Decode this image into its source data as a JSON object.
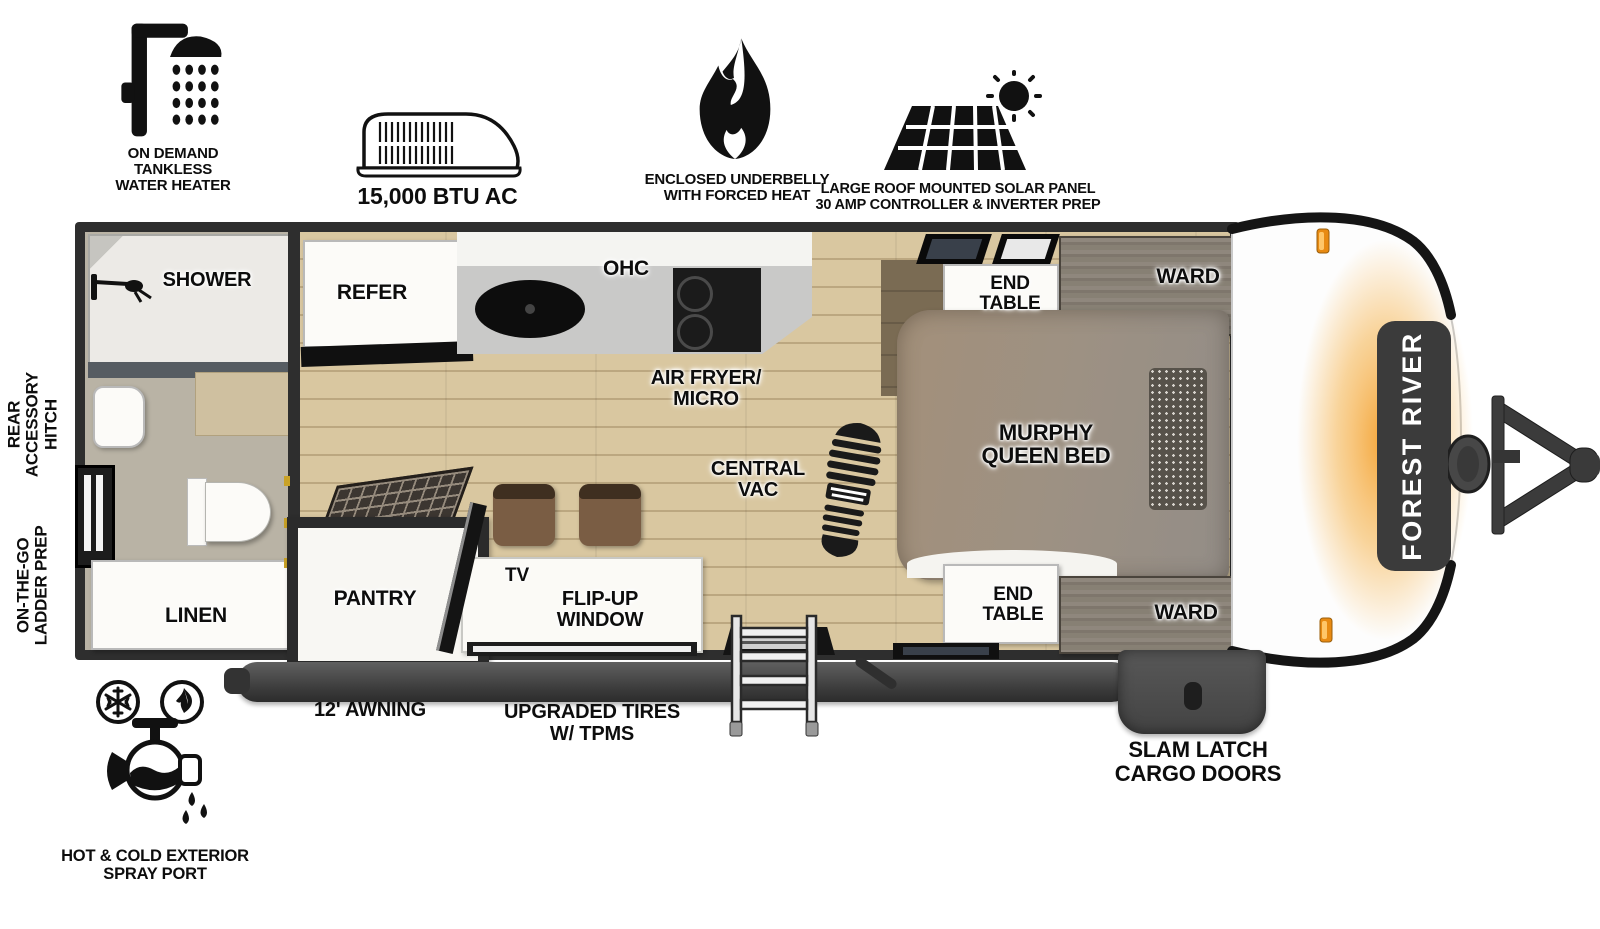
{
  "top_features": {
    "water_heater": "ON DEMAND\nTANKLESS\nWATER HEATER",
    "ac": "15,000 BTU AC",
    "underbelly": "ENCLOSED UNDERBELLY\nWITH FORCED HEAT",
    "solar": "LARGE ROOF MOUNTED SOLAR PANEL\n30 AMP CONTROLLER & INVERTER PREP"
  },
  "side_labels": {
    "rear_accessory_hitch": "REAR\nACCESSORY\nHITCH",
    "ladder_prep": "ON-THE-GO\nLADDER PREP"
  },
  "plan": {
    "shower": "SHOWER",
    "linen": "LINEN",
    "refer": "REFER",
    "ohc": "OHC",
    "air_fryer_micro": "AIR FRYER/\nMICRO",
    "central_vac": "CENTRAL\nVAC",
    "end_table_top": "END\nTABLE",
    "ward_top": "WARD",
    "murphy_bed": "MURPHY\nQUEEN BED",
    "end_table_bottom": "END\nTABLE",
    "ward_bottom": "WARD",
    "pantry": "PANTRY",
    "tv": "TV",
    "flip_up_window": "FLIP-UP\nWINDOW"
  },
  "bottom_features": {
    "awning": "12' AWNING",
    "tires": "UPGRADED TIRES\nW/ TPMS",
    "cargo_doors": "SLAM LATCH\nCARGO DOORS",
    "spray_port": "HOT & COLD EXTERIOR\nSPRAY PORT"
  },
  "brand": "FOREST RIVER",
  "colors": {
    "wall": "#2e2e2e",
    "wood_floor": "#d9c7a0",
    "bath_floor": "#b9b3a5",
    "accent_orange": "#f49a20",
    "badge": "#3b3b3b"
  }
}
